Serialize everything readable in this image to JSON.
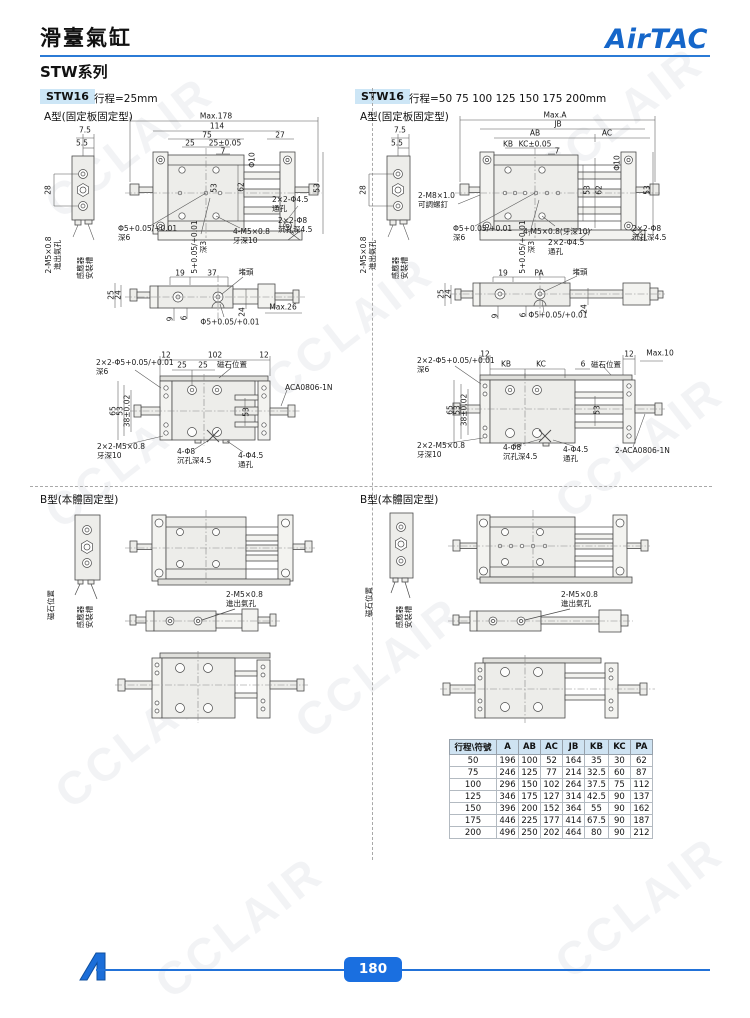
{
  "page": {
    "watermark": "CCLAIR",
    "page_number": "180"
  },
  "header": {
    "title": "滑臺氣缸",
    "series": "STW系列",
    "brand": "AirTAC"
  },
  "sections": {
    "left": {
      "model": "STW16",
      "stroke": "行程=25mm",
      "type_a": "A型(固定板固定型)",
      "type_b": "B型(本體固定型)"
    },
    "right": {
      "model": "STW16",
      "stroke": "行程=50 75 100 125 150 175 200mm",
      "type_a": "A型(固定板固定型)",
      "type_b": "B型(本體固定型)"
    }
  },
  "labels": {
    "port": "2-M5×0.8\n進出氣孔",
    "sensor": "感應器\n安裝槽",
    "magnet": "磁石位置",
    "plug": "堵頭",
    "adj": "2-M8×1.0\n可調螺釘"
  },
  "dims": {
    "la": {
      "d75": "7.5",
      "d55": "5.5",
      "d28": "28",
      "max": "Max.178",
      "d114": "114",
      "d75w": "75",
      "d27": "27",
      "d25": "25",
      "d2505": "25±0.05",
      "d7": "7",
      "dia10": "Φ10",
      "d62": "62",
      "d53": "53",
      "d53r": "53",
      "holes45": "2×2-Φ4.5\n通孔",
      "holes8": "2×2-Φ8\n沉孔深4.5",
      "tap": "4-M5×0.8\n牙深10",
      "pin": "Φ5+0.05/+0.01\n深6",
      "pin2": "5+0.05/+0.01\n深3"
    },
    "lm": {
      "d19": "19",
      "d37": "37",
      "d25": "25",
      "d24": "24",
      "d9": "9",
      "d6": "6",
      "d24r": "24",
      "max26": "Max.26",
      "pin": "Φ5+0.05/+0.01"
    },
    "lb": {
      "d12l": "12",
      "d102": "102",
      "d12r": "12",
      "d25a": "25",
      "d25b": "25",
      "pins": "2×2-Φ5+0.05/+0.01\n深6",
      "d65": "65",
      "d53": "53",
      "d38": "38±0.02",
      "d53c": "53",
      "tap": "2×2-M5×0.8\n牙深10",
      "cbore": "4-Φ8\n沉孔深4.5",
      "thru": "4-Φ4.5\n通孔",
      "part": "ACA0806-1N"
    },
    "ra": {
      "d75": "7.5",
      "d55": "5.5",
      "d28": "28",
      "max": "Max.A",
      "jb": "JB",
      "ab": "AB",
      "ac": "AC",
      "kb": "KB",
      "kc": "KC±0.05",
      "d7": "7",
      "dia10": "Φ10",
      "d53": "53",
      "d62": "62",
      "d53r": "53",
      "tap": "4-M5×0.8(牙深10)",
      "holes45": "2×2-Φ4.5\n通孔",
      "holes8": "2×2-Φ8\n沉孔深4.5",
      "pin": "Φ5+0.05/+0.01\n深6",
      "pin2": "5+0.05/+0.01\n深3"
    },
    "rm": {
      "d19": "19",
      "pa": "PA",
      "d25": "25",
      "d24": "24",
      "d9": "9",
      "d6": "6",
      "d24r": "24",
      "pin": "Φ5+0.05/+0.01"
    },
    "rb": {
      "d12l": "12",
      "kb": "KB",
      "kc": "KC",
      "d6": "6",
      "d12r": "12",
      "max10": "Max.10",
      "pins": "2×2-Φ5+0.05/+0.01\n深6",
      "d65": "65",
      "d53": "53",
      "d38": "38±0.02",
      "d53c": "53",
      "tap": "2×2-M5×0.8\n牙深10",
      "cbore": "4-Φ8\n沉孔深4.5",
      "thru": "4-Φ4.5\n通孔",
      "part": "2-ACA0806-1N"
    }
  },
  "table": {
    "header": [
      "行程\\符號",
      "A",
      "AB",
      "AC",
      "JB",
      "KB",
      "KC",
      "PA"
    ],
    "rows": [
      [
        "50",
        "196",
        "100",
        "52",
        "164",
        "35",
        "30",
        "62"
      ],
      [
        "75",
        "246",
        "125",
        "77",
        "214",
        "32.5",
        "60",
        "87"
      ],
      [
        "100",
        "296",
        "150",
        "102",
        "264",
        "37.5",
        "75",
        "112"
      ],
      [
        "125",
        "346",
        "175",
        "127",
        "314",
        "42.5",
        "90",
        "137"
      ],
      [
        "150",
        "396",
        "200",
        "152",
        "364",
        "55",
        "90",
        "162"
      ],
      [
        "175",
        "446",
        "225",
        "177",
        "414",
        "67.5",
        "90",
        "187"
      ],
      [
        "200",
        "496",
        "250",
        "202",
        "464",
        "80",
        "90",
        "212"
      ]
    ]
  }
}
